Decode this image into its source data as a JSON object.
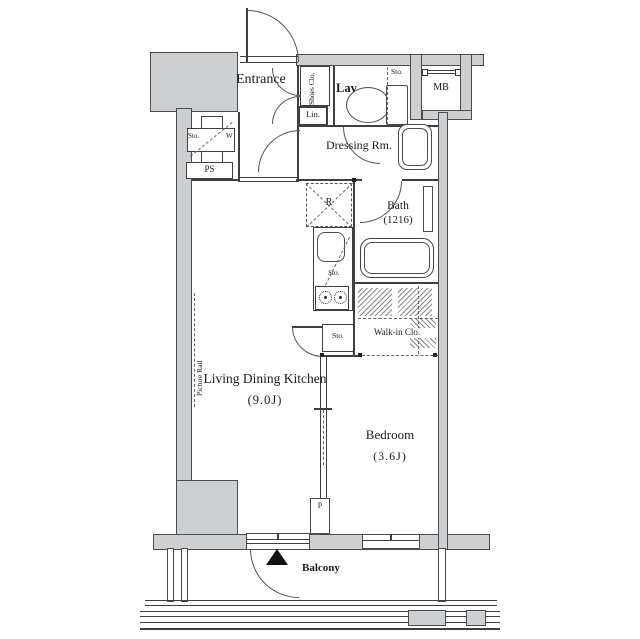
{
  "title": "Apartment floor plan",
  "labels": {
    "entrance": "Entrance",
    "shoes_clo": "Shoes Clo.",
    "lav": "Lav.",
    "sto": "Sto.",
    "lin": "Lin.",
    "mb": "MB",
    "dressing": "Dressing Rm.",
    "w": "W",
    "ps": "PS",
    "fridge": "R",
    "bath": "Bath",
    "bath_size": "(1216)",
    "walkin": "Walk-in Clo.",
    "ldk": "Living Dining Kitchen",
    "ldk_size": "(9.0J)",
    "bedroom": "Bedroom",
    "bedroom_size": "(3.6J)",
    "picture_rail": "Picture Rail",
    "pipe": "P",
    "balcony": "Balcony"
  },
  "colors": {
    "wall_fill": "#ccd0d3",
    "line": "#3f3f3f",
    "text": "#1c1c1c"
  }
}
